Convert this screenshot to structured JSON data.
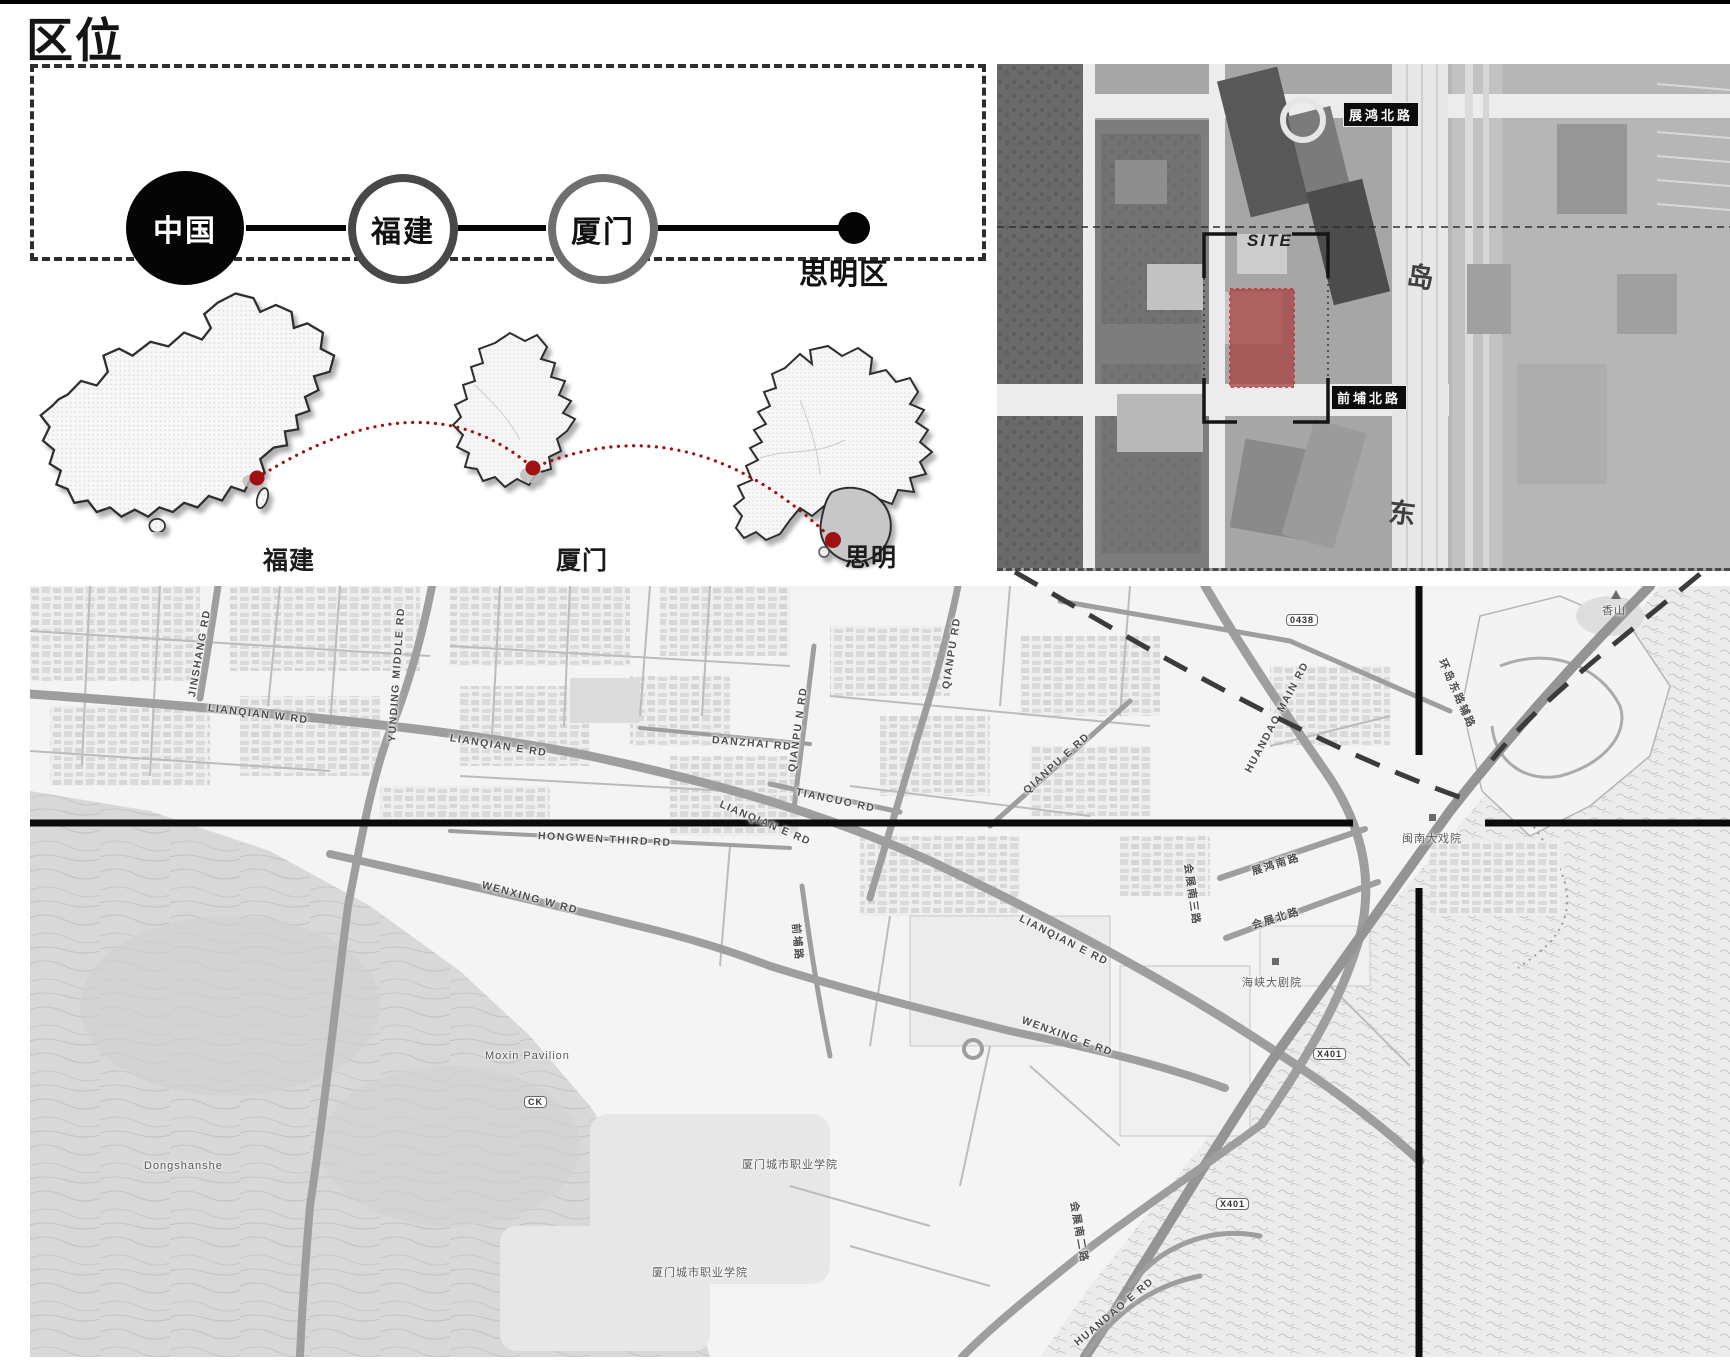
{
  "title": "区位",
  "flow": {
    "nodes": [
      {
        "label": "中国",
        "style": "filled-black"
      },
      {
        "label": "福建",
        "style": "outlined-dark"
      },
      {
        "label": "厦门",
        "style": "outlined-gray"
      }
    ],
    "terminal": {
      "label": "思明区"
    }
  },
  "minimaps": [
    {
      "name": "china-map",
      "label": "福建",
      "label_x": 263,
      "label_y": 541
    },
    {
      "name": "fujian-map",
      "label": "厦门",
      "label_x": 556,
      "label_y": 541
    },
    {
      "name": "xiamen-map",
      "label": "思明",
      "label_x": 845,
      "label_y": 538
    }
  ],
  "aerial": {
    "site_label": "SITE",
    "road_tags": [
      {
        "text": "展鸿北路",
        "x": 346,
        "y": 38
      },
      {
        "text": "前埔北路",
        "x": 334,
        "y": 321
      }
    ],
    "glyphs": [
      {
        "text": "岛",
        "x": 410,
        "y": 190,
        "r": 7
      },
      {
        "text": "东",
        "x": 392,
        "y": 426,
        "r": 7
      }
    ]
  },
  "map": {
    "road_labels": [
      {
        "text": "LIANQIAN W RD",
        "x": 178,
        "y": 116,
        "r": 7
      },
      {
        "text": "LIANQIAN E RD",
        "x": 420,
        "y": 146,
        "r": 9
      },
      {
        "text": "LIANQIAN E RD",
        "x": 690,
        "y": 212,
        "r": 23
      },
      {
        "text": "LIANQIAN E RD",
        "x": 990,
        "y": 326,
        "r": 27
      },
      {
        "text": "YUNDING MIDDLE RD",
        "x": 362,
        "y": 150,
        "r": -86
      },
      {
        "text": "JINSHANG RD",
        "x": 162,
        "y": 105,
        "r": -80
      },
      {
        "text": "QIANPU RD",
        "x": 916,
        "y": 97,
        "r": -81
      },
      {
        "text": "QIANPU N RD",
        "x": 762,
        "y": 180,
        "r": -82
      },
      {
        "text": "QIANPU E RD",
        "x": 995,
        "y": 200,
        "r": -42
      },
      {
        "text": "DANZHAI RD",
        "x": 682,
        "y": 148,
        "r": 5
      },
      {
        "text": "HONGWEN-THIRD RD",
        "x": 508,
        "y": 244,
        "r": 3
      },
      {
        "text": "WENXING W RD",
        "x": 452,
        "y": 293,
        "r": 15
      },
      {
        "text": "WENXING E RD",
        "x": 992,
        "y": 428,
        "r": 20
      },
      {
        "text": "TIANCUO RD",
        "x": 766,
        "y": 200,
        "r": 12
      },
      {
        "text": "HUANDAO MAIN RD",
        "x": 1218,
        "y": 180,
        "r": -62
      },
      {
        "text": "HUANDAO E RD",
        "x": 1046,
        "y": 752,
        "r": -40
      },
      {
        "text": "环岛东路辅路",
        "x": 1412,
        "y": 66,
        "r": 66,
        "cn": true
      },
      {
        "text": "展鸿南路",
        "x": 1222,
        "y": 278,
        "r": -17,
        "cn": true
      },
      {
        "text": "会展北路",
        "x": 1222,
        "y": 332,
        "r": -17,
        "cn": true
      },
      {
        "text": "会展南二路",
        "x": 1044,
        "y": 608,
        "r": 80,
        "cn": true
      },
      {
        "text": "会展南三路",
        "x": 1158,
        "y": 270,
        "r": 82,
        "cn": true
      },
      {
        "text": "前埔路",
        "x": 766,
        "y": 330,
        "r": 85,
        "cn": true
      }
    ],
    "poi_labels": [
      {
        "text": "海峡大剧院",
        "x": 1212,
        "y": 388
      },
      {
        "text": "闽南大戏院",
        "x": 1372,
        "y": 244
      },
      {
        "text": "香山",
        "x": 1572,
        "y": 16
      },
      {
        "text": "Moxin Pavilion",
        "x": 455,
        "y": 464
      },
      {
        "text": "Dongshanshe",
        "x": 114,
        "y": 574
      },
      {
        "text": "厦门城市职业学院",
        "x": 712,
        "y": 570
      },
      {
        "text": "厦门城市职业学院",
        "x": 622,
        "y": 678
      }
    ],
    "badges": [
      {
        "text": "0438",
        "x": 1256,
        "y": 28
      },
      {
        "text": "X401",
        "x": 1283,
        "y": 462
      },
      {
        "text": "X401",
        "x": 1186,
        "y": 612
      },
      {
        "text": "CK",
        "x": 494,
        "y": 510
      }
    ]
  },
  "colors": {
    "accent_red": "#a01212",
    "site_fill": "#a84848",
    "ink": "#111111",
    "road_gray": "#9e9e9e"
  }
}
